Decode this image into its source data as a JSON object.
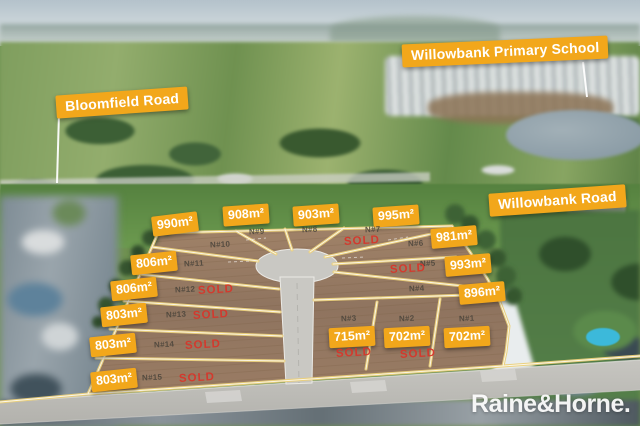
{
  "road_labels": {
    "primary_school": "Willowbank Primary School",
    "bloomfield": "Bloomfield Road",
    "willowbank": "Willowbank Road"
  },
  "sold_text": "SOLD",
  "brand_logo": "Raine&Horne.",
  "lots": {
    "l1": {
      "num": "N#1",
      "size": "702m²",
      "sold": false
    },
    "l2": {
      "num": "N#2",
      "size": "702m²",
      "sold": true
    },
    "l3": {
      "num": "N#3",
      "size": "715m²",
      "sold": true
    },
    "l4": {
      "num": "N#4",
      "size": "896m²",
      "sold": false
    },
    "l5": {
      "num": "N#5",
      "size": "993m²",
      "sold": true
    },
    "l6": {
      "num": "N#6",
      "size": "981m²",
      "sold": false
    },
    "l7": {
      "num": "N#7",
      "size": "995m²",
      "sold": true
    },
    "l8": {
      "num": "N#8",
      "size": "903m²",
      "sold": false
    },
    "l9": {
      "num": "N#9",
      "size": "908m²",
      "sold": false
    },
    "l10": {
      "num": "N#10",
      "size": "990m²",
      "sold": false
    },
    "l11": {
      "num": "N#11",
      "size": "806m²",
      "sold": false
    },
    "l12": {
      "num": "N#12",
      "size": "806m²",
      "sold": true
    },
    "l13": {
      "num": "N#13",
      "size": "803m²",
      "sold": true
    },
    "l14": {
      "num": "N#14",
      "size": "803m²",
      "sold": true
    },
    "l15": {
      "num": "N#15",
      "size": "803m²",
      "sold": true
    }
  },
  "colors": {
    "label_bg": "#F2A71B",
    "label_text": "#FFFFFF",
    "sold": "#D8352A",
    "lot_line": "#EBD07C",
    "lot_number": "#4A443B"
  }
}
